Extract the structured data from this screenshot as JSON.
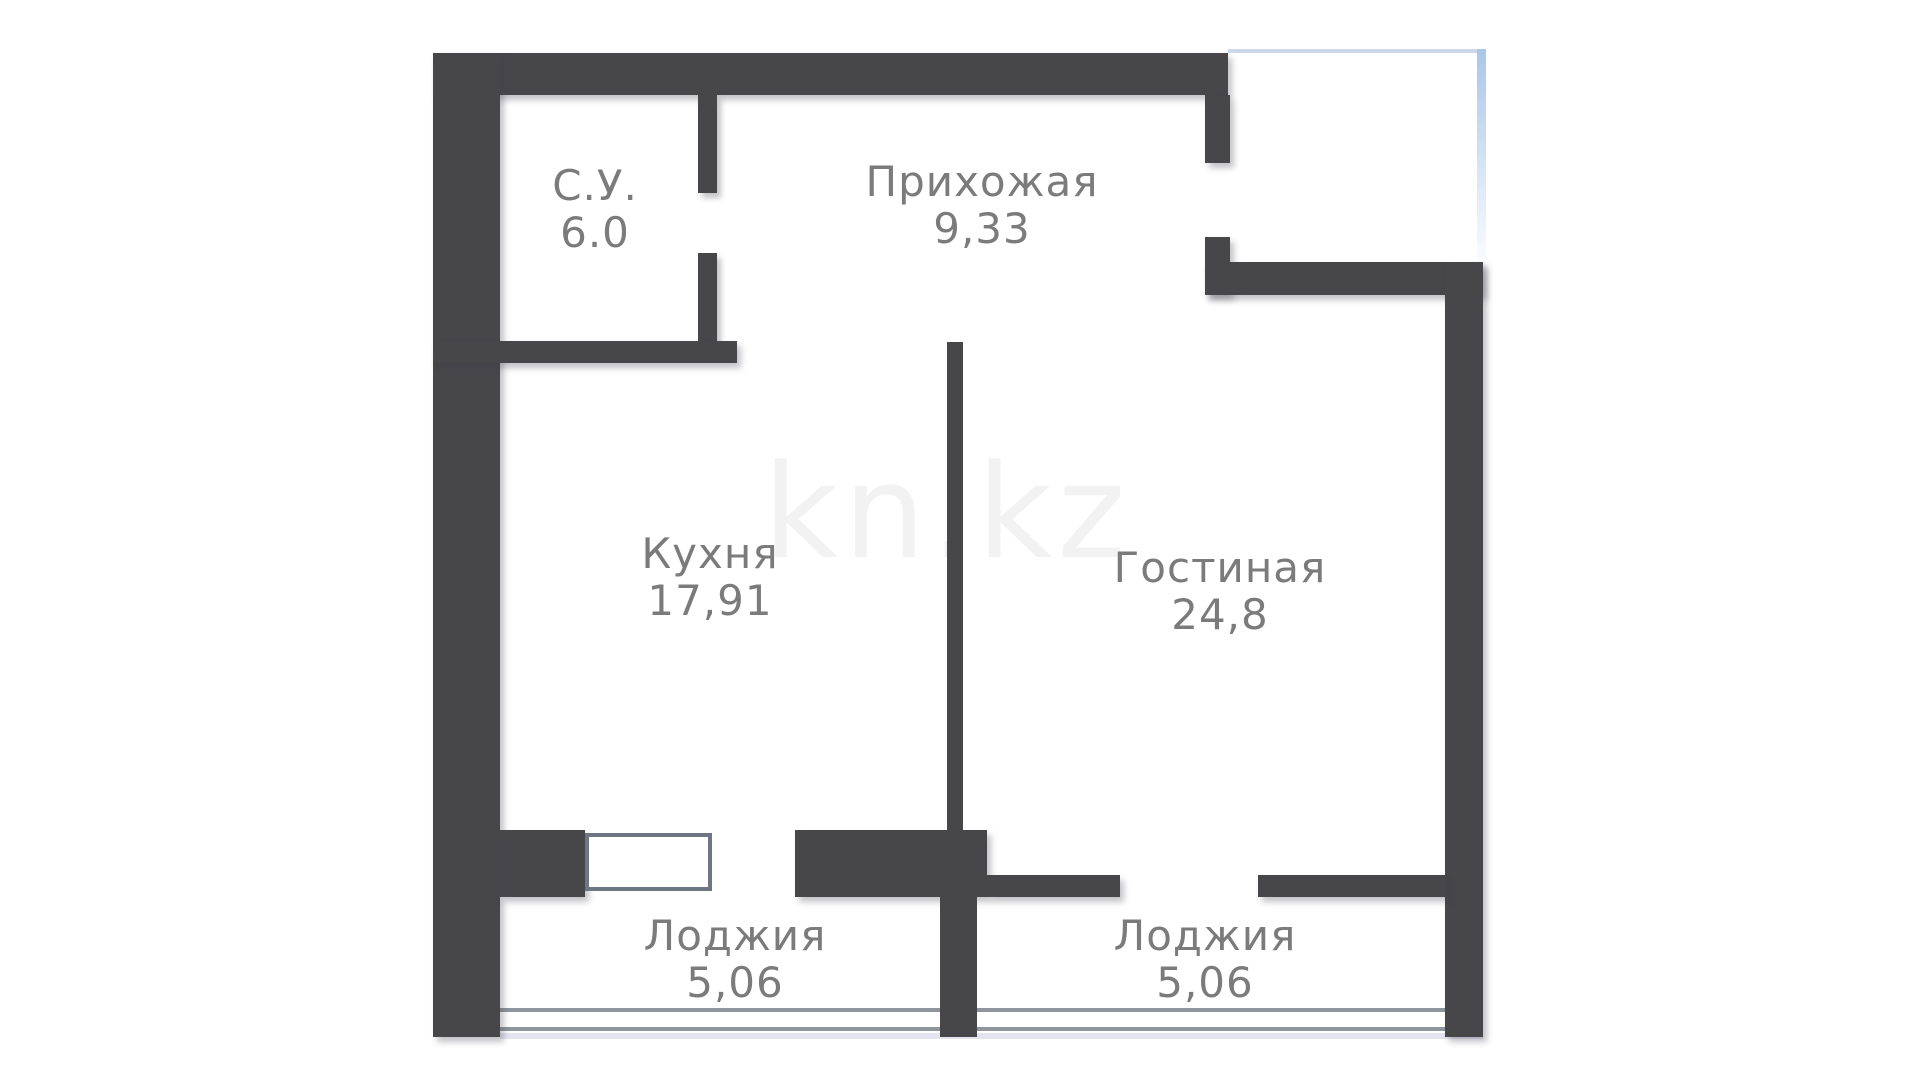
{
  "plan": {
    "rooms": [
      {
        "id": "bathroom",
        "name": "С.У.",
        "area": "6.0"
      },
      {
        "id": "hallway",
        "name": "Прихожая",
        "area": "9,33"
      },
      {
        "id": "kitchen",
        "name": "Кухня",
        "area": "17,91"
      },
      {
        "id": "living-room",
        "name": "Гостиная",
        "area": "24,8"
      },
      {
        "id": "loggia-kitchen",
        "name": "Лоджия",
        "area": "5,06"
      },
      {
        "id": "loggia-living",
        "name": "Лоджия",
        "area": "5,06"
      }
    ],
    "watermark": "kn.kz",
    "colors": {
      "wall": "#47474a",
      "label": "#7b7b7b",
      "watermark": "#f2f2f2",
      "window_border": "#6d7682",
      "loggia_line": "#8f959c",
      "edge_blue": "#a9c6ea"
    }
  }
}
